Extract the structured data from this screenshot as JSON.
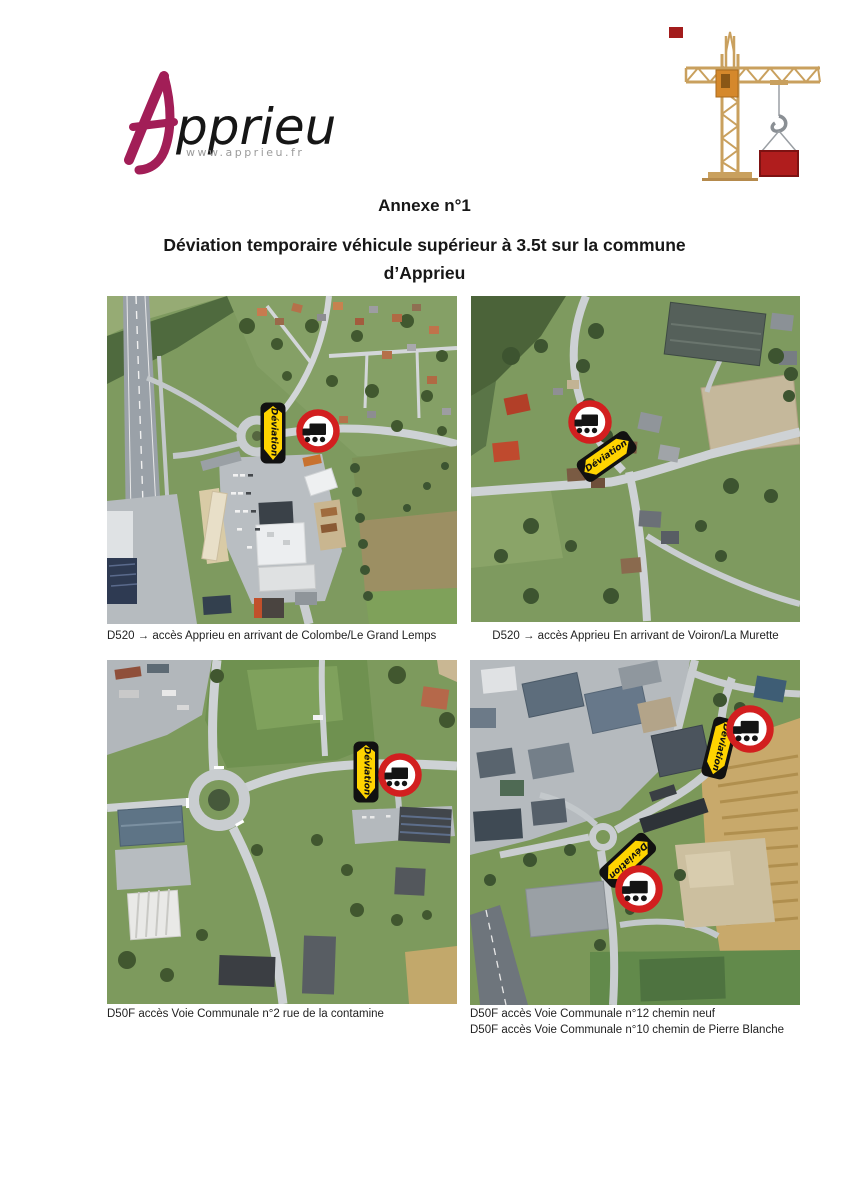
{
  "header": {
    "logo": {
      "letter": "A",
      "wordmark": "pprieu",
      "website": "www.apprieu.fr"
    }
  },
  "titles": {
    "annex": "Annexe n°1",
    "subtitle_line1": "Déviation temporaire véhicule supérieur à 3.5t sur la commune",
    "subtitle_line2": "d’Apprieu"
  },
  "maps": [
    {
      "name": "d520-from-colombe",
      "caption": "D520 → accès Apprieu en arrivant de Colombe/Le Grand Lemps",
      "sign_labels": [
        "Déviation"
      ]
    },
    {
      "name": "d520-from-voiron",
      "caption": "D520 → accès Apprieu En arrivant de Voiron/La Murette",
      "sign_labels": [
        "Déviation"
      ]
    },
    {
      "name": "d50f-voie-communale-2",
      "caption": "D50F accès Voie Communale n°2 rue de la contamine",
      "sign_labels": [
        "Déviation"
      ]
    },
    {
      "name": "d50f-voie-communale-12-10",
      "caption_line1": "D50F accès Voie Communale n°12 chemin neuf",
      "caption_line2": "D50F accès Voie Communale n°10 chemin de Pierre Blanche",
      "sign_labels": [
        "Déviation",
        "Déviation"
      ]
    }
  ],
  "icons": {
    "crane": "tower-crane-illustration",
    "deviation": "deviation-arrow-panel",
    "no_trucks": "no-trucks-prohibition-sign"
  },
  "colors": {
    "brand_magenta": "#a21e57",
    "sign_yellow": "#ffd400",
    "sign_red": "#d21f1f",
    "crane_tan": "#c9a05e",
    "crane_cab_orange": "#d5882b",
    "crane_load_red": "#b01d1d",
    "text": "#171717"
  }
}
